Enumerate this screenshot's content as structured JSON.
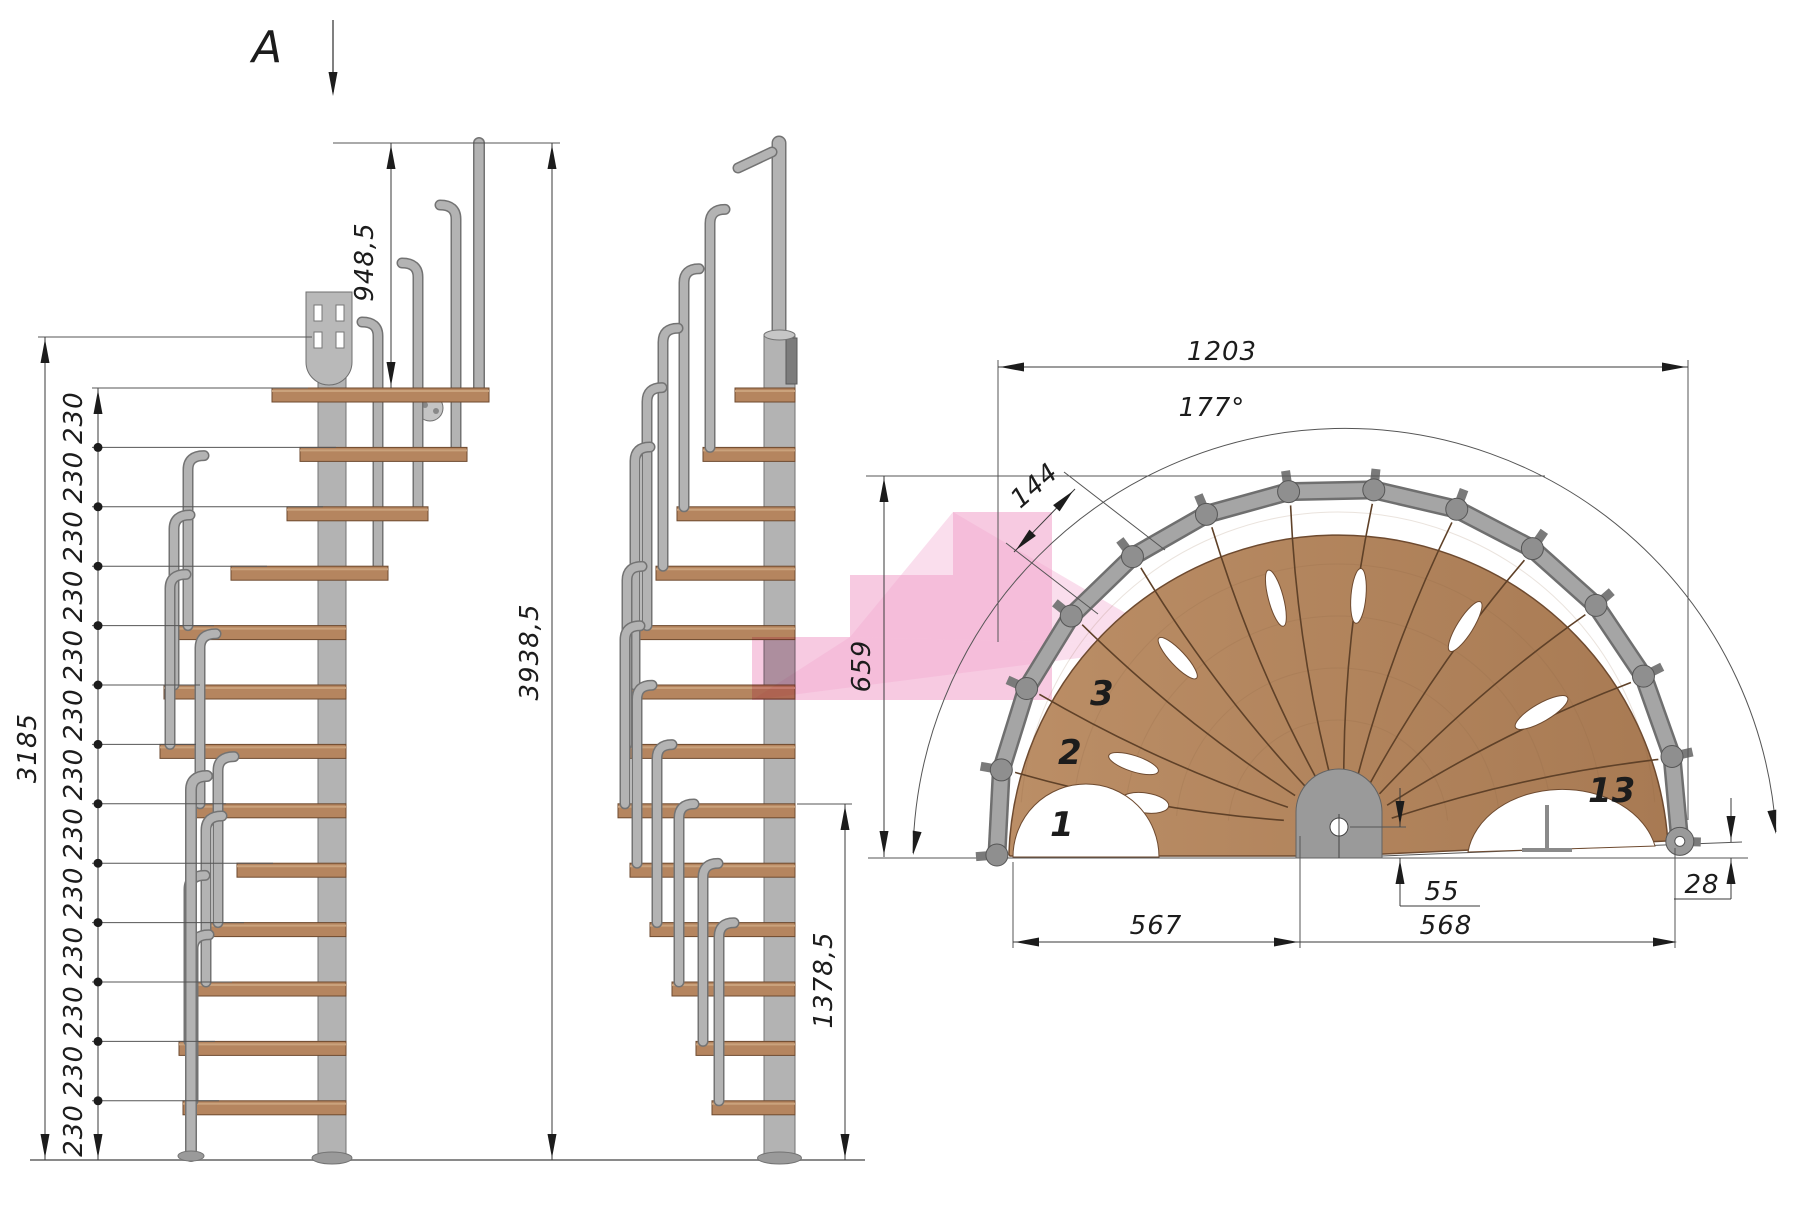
{
  "drawing": {
    "type": "spiral-staircase technical drawing",
    "views": {
      "section_arrow_label": "A",
      "left_elevation": "front elevation",
      "middle_elevation": "side elevation",
      "plan": "top plan view"
    },
    "colors": {
      "background": "#ffffff",
      "wood": "#b5855f",
      "wood_dark": "#6e4a2f",
      "metal": "#b3b3b3",
      "metal_dark": "#737373",
      "pink_highlight": "#f2a9cf",
      "dim_line": "#3a3a3a"
    }
  },
  "dims": {
    "left": {
      "rail_height": "948,5",
      "total_height": "3938,5",
      "stair_height": "3185",
      "spacing_label": "230",
      "spacing_count": 13
    },
    "middle": {
      "lower_height": "1378,5"
    },
    "plan": {
      "overall_width": "1203",
      "sweep_angle": "177°",
      "tread_depth": "144",
      "footprint_depth": "659",
      "left_half": "567",
      "right_half": "568",
      "center_offset": "55",
      "end_offset": "28"
    }
  },
  "steps": {
    "first": "1",
    "second": "2",
    "third": "3",
    "last": "13"
  },
  "geometry": {
    "tread_levels_y_start": 388,
    "tread_step": 59.4,
    "tread_count": 13,
    "left_stair": {
      "left": [
        272,
        300,
        287,
        231,
        178,
        164,
        160,
        190,
        237,
        208,
        196,
        179,
        183
      ],
      "right": [
        489,
        467,
        428,
        388,
        346,
        346,
        346,
        346,
        346,
        346,
        346,
        346,
        346
      ],
      "pole_x": 318,
      "pole_w": 28
    },
    "middle_stair": {
      "left": [
        735,
        703,
        677,
        656,
        640,
        628,
        620,
        618,
        630,
        650,
        672,
        696,
        712
      ],
      "right_edge": 795,
      "pole_x": 764,
      "pole_w": 31
    },
    "plan": {
      "cx": 1338,
      "cy": 830,
      "wood_r": 330,
      "rail_r": 342,
      "stub_r": 363,
      "start_deg": 184.2,
      "end_deg": -1.9
    }
  }
}
